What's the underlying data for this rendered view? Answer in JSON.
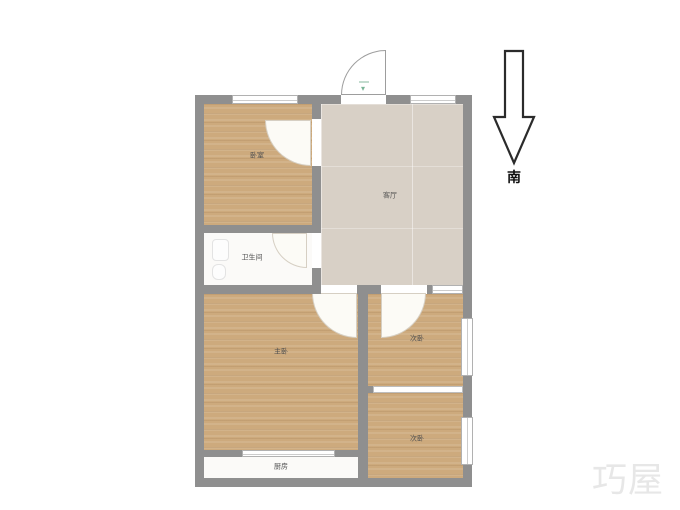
{
  "compass": {
    "south_label": "南"
  },
  "watermark": {
    "text": "巧屋"
  },
  "entry": {
    "marker_glyph": "▾"
  },
  "rooms": {
    "bedroom1": {
      "label": "卧室"
    },
    "living": {
      "label": "客厅"
    },
    "bathroom": {
      "label": "卫生间"
    },
    "master": {
      "label": "主卧"
    },
    "bedroom2": {
      "label": "次卧"
    },
    "bedroom3": {
      "label": "次卧"
    },
    "kitchen": {
      "label": "厨房"
    }
  },
  "colors": {
    "wall": "#8f8f8f",
    "wood_floor": "#cdaa7d",
    "living_floor": "#d8d0c6",
    "tile_floor": "#fbfaf8",
    "entry_marker": "#7bb597",
    "compass_outline": "#2b2b2b",
    "watermark": "#e7e7e7"
  }
}
